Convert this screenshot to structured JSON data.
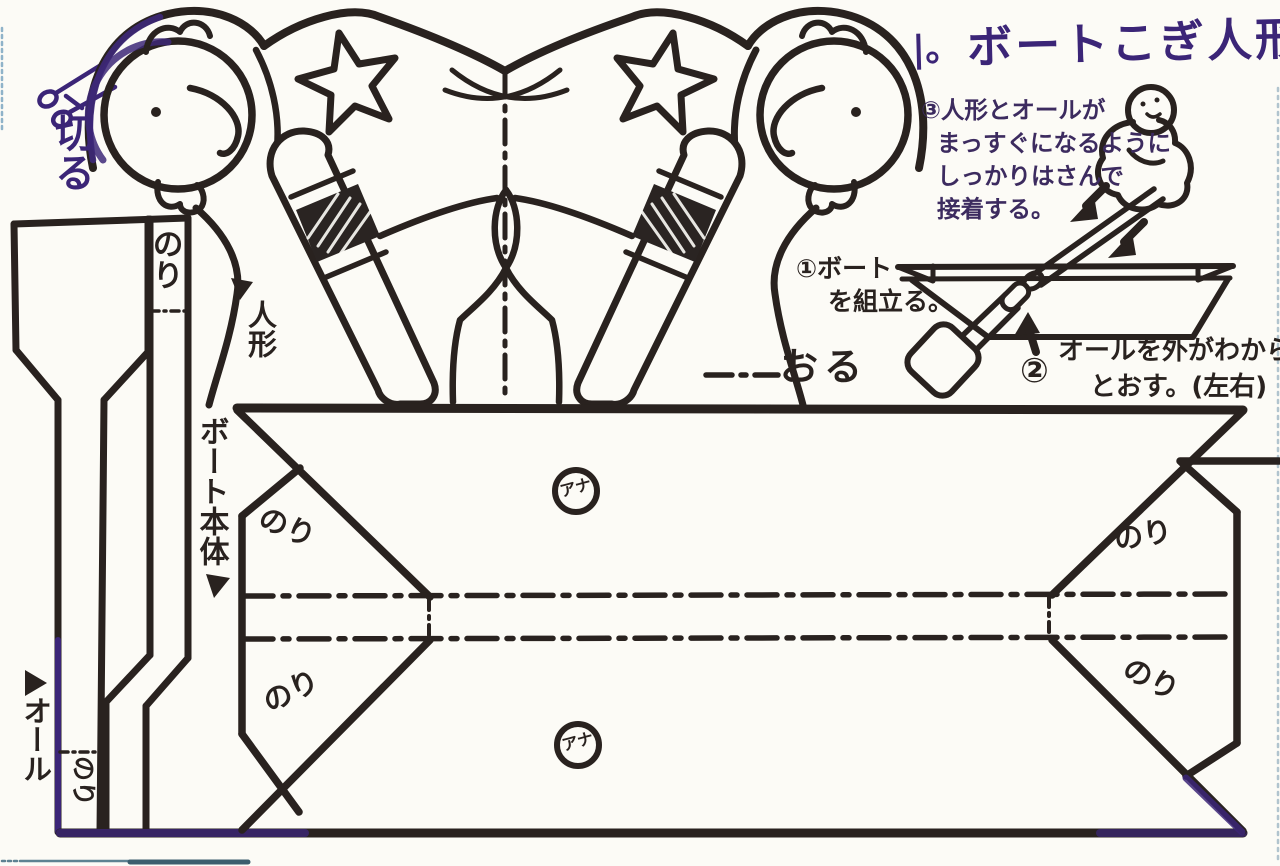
{
  "title": {
    "open": "|。",
    "text": "ボートこぎ人形",
    "close": "|"
  },
  "instructions": {
    "step1": {
      "lines": [
        "①ボート",
        "を組立る。"
      ]
    },
    "step2": {
      "badge": "②",
      "lines": [
        "オールを外がわから",
        "とおす。(左右)"
      ]
    },
    "step3": {
      "lines": [
        "③人形とオールが",
        "まっすぐになるように",
        "しっかりはさんで",
        "接着する。"
      ]
    }
  },
  "labels": {
    "cut": "切る",
    "fold": "おる",
    "doll": "人形",
    "boat_body": "ボート本体",
    "oar": "オール",
    "glue_strip": "のり",
    "oar_glue": "のり",
    "flap_left_top": "のり",
    "flap_left_bottom": "のり",
    "flap_right_top": "のり",
    "flap_right_bottom": "のり",
    "hole_top": "アナ",
    "hole_bottom": "アナ"
  },
  "colors": {
    "ink": "#29221f",
    "purple": "#3b2577",
    "paper": "#fcfbf6"
  }
}
